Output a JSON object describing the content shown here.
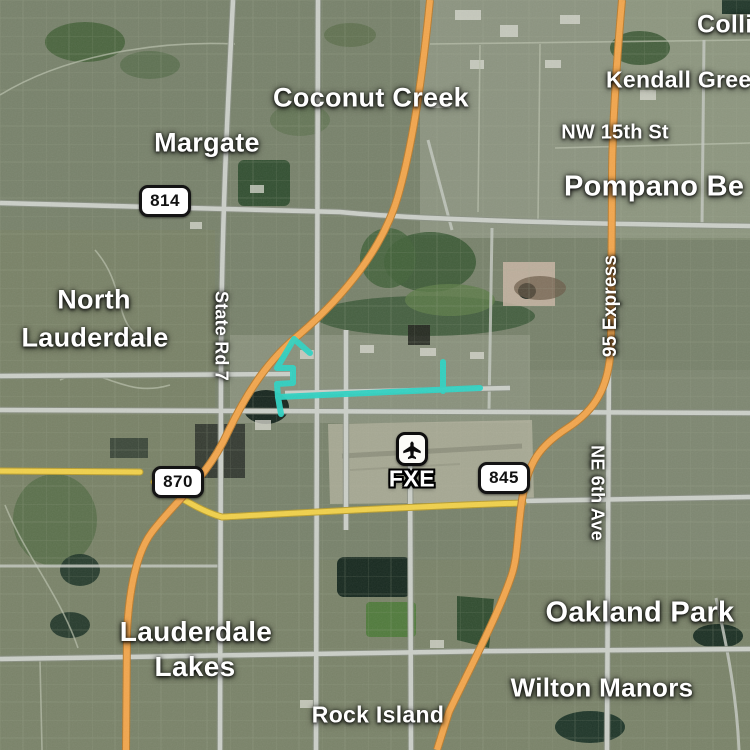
{
  "colors": {
    "route": "#2ed3c3",
    "highway_orange": "#f2a64d",
    "road_yellow": "#f1d14b",
    "road_gray": "#cbcfc8"
  },
  "city_labels": [
    {
      "text": "Coconut Creek"
    },
    {
      "text": "Margate"
    },
    {
      "text": "Colli"
    },
    {
      "text": "Kendall Gree"
    },
    {
      "text": "Pompano Be"
    },
    {
      "text": "North"
    },
    {
      "text": "Lauderdale"
    },
    {
      "text": "Lauderdale"
    },
    {
      "text": "Lakes"
    },
    {
      "text": "Oakland Park"
    },
    {
      "text": "Wilton Manors"
    },
    {
      "text": "Rock Island"
    }
  ],
  "road_labels": [
    {
      "text": "NW 15th St"
    },
    {
      "text": "State Rd 7"
    },
    {
      "text": "95 Express"
    },
    {
      "text": "NE 6th Ave"
    }
  ],
  "shields": [
    {
      "number": "814"
    },
    {
      "number": "870"
    },
    {
      "number": "845"
    }
  ],
  "airport": {
    "code": "FXE",
    "icon": "airplane"
  }
}
